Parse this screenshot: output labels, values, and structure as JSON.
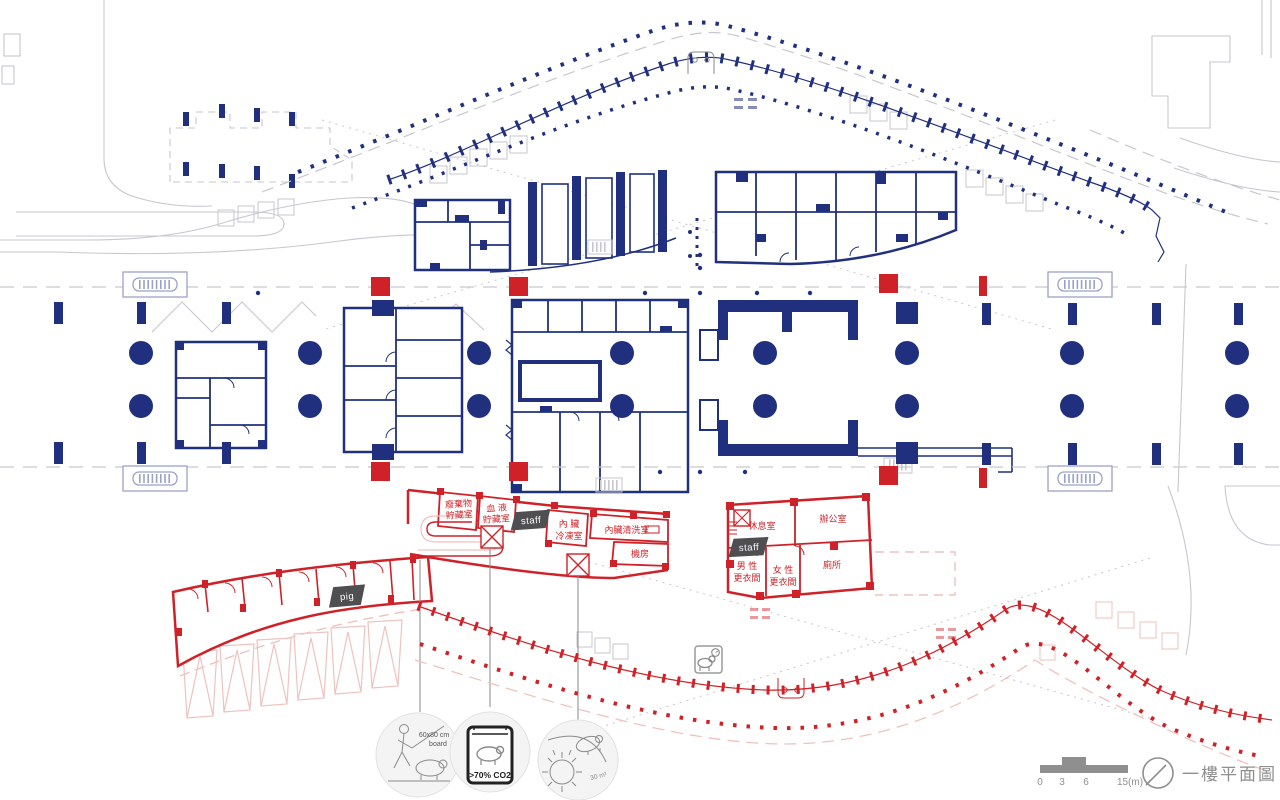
{
  "colors": {
    "navy": "#20307f",
    "red": "#cf2128",
    "pale_red": "#eec3bf",
    "gray": "#c7c7cf",
    "sketch": "#8a8a8a",
    "pale_navy": "#9ba2c9",
    "dark_tag": "#4f4f52",
    "footer_gray": "#8f8f8f",
    "pale_fill": "#f4f4f4"
  },
  "plan": {
    "rooms": {
      "waste_storage": {
        "line1": "廢棄物",
        "line2": "貯藏室"
      },
      "blood_storage": {
        "line1": "血 液",
        "line2": "貯藏室"
      },
      "organ_freezer": {
        "line1": "內 臟",
        "line2": "冷凍室"
      },
      "organ_washing": {
        "label": "內臟清洗室"
      },
      "machine_room": {
        "label": "機房"
      },
      "lounge": {
        "label": "休息室"
      },
      "office": {
        "label": "辦公室"
      },
      "mens_locker": {
        "line1": "男 性",
        "line2": "更衣間"
      },
      "womens_locker": {
        "line1": "女 性",
        "line2": "更衣間"
      },
      "toilet": {
        "label": "廁所"
      }
    },
    "tags": {
      "staff": "staff",
      "pig": "pig"
    }
  },
  "callouts": {
    "stun_board": {
      "line1": "60x80 cm",
      "line2": "board"
    },
    "co2_chamber": {
      "label": ">70% CO2"
    },
    "scalding": {
      "label": "30 m²"
    }
  },
  "footer": {
    "scale": {
      "t0": "0",
      "t1": "3",
      "t2": "6",
      "t3": "15(m)"
    },
    "title": "一樓平面圖"
  }
}
